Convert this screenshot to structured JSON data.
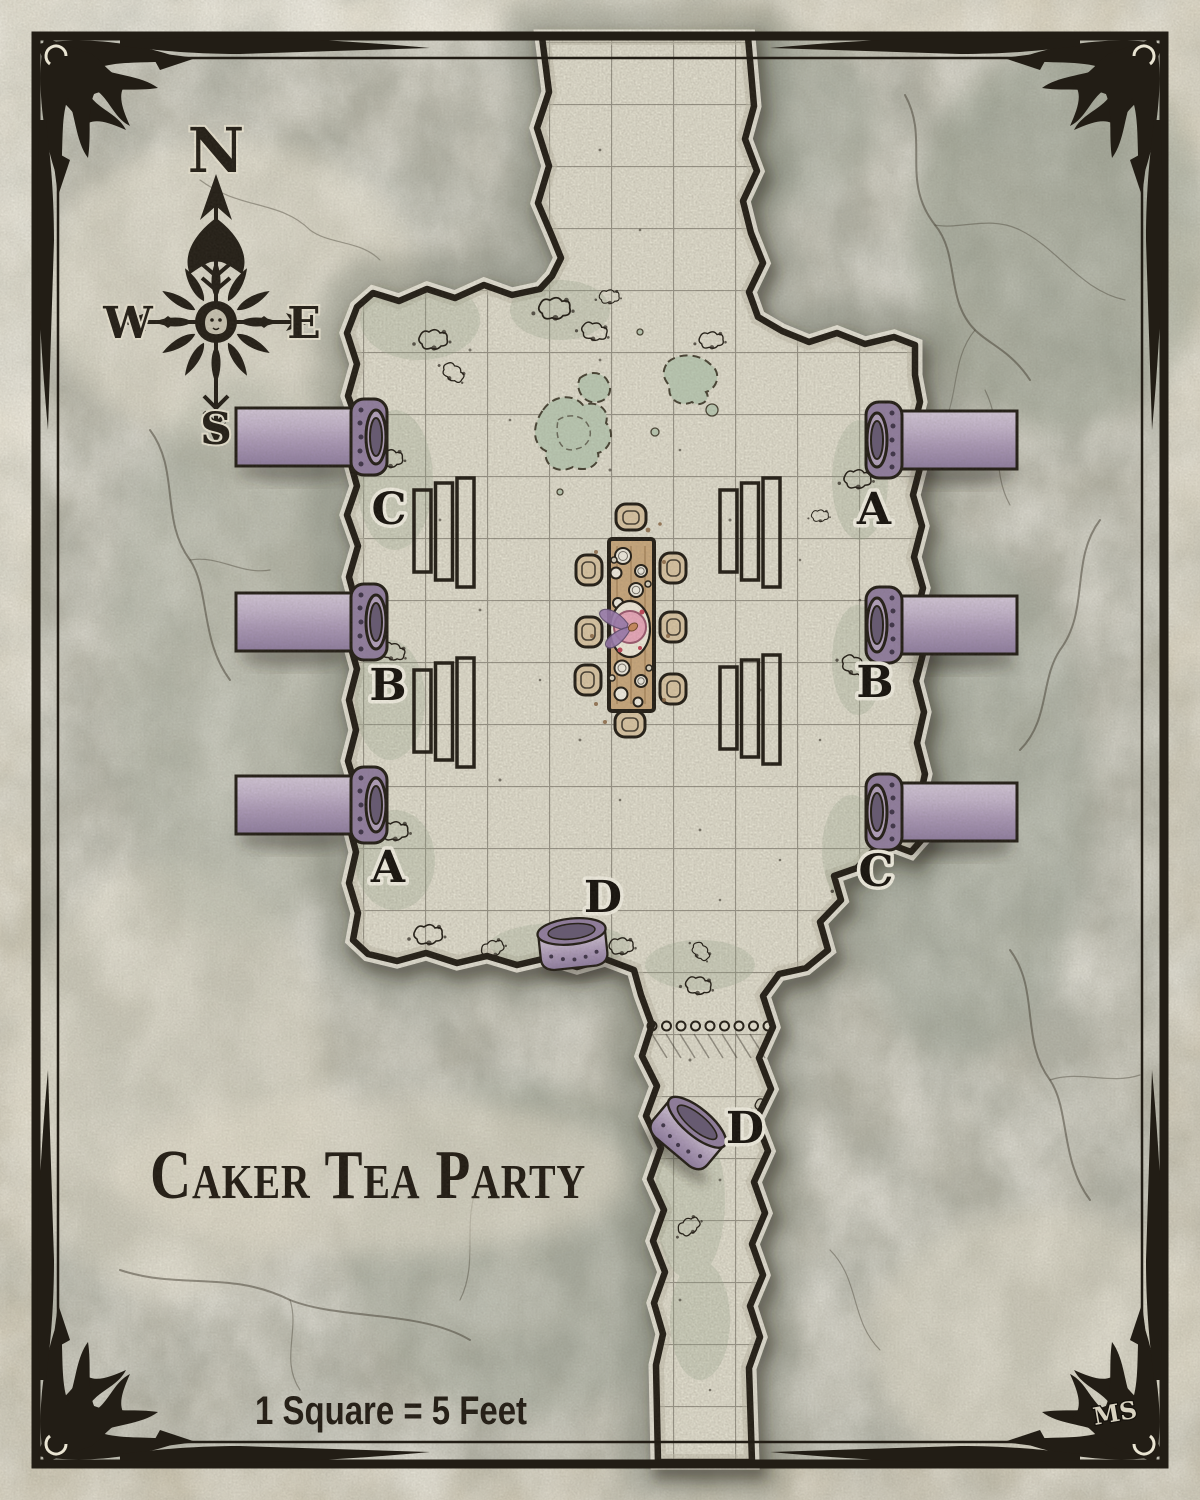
{
  "map": {
    "title": "Caker Tea Party",
    "scale_note": "1 Square = 5 Feet",
    "signature": "MS",
    "compass": {
      "north": "N",
      "east": "E",
      "south": "S",
      "west": "W"
    },
    "pipe_labels": [
      {
        "name": "west-top",
        "text": "C"
      },
      {
        "name": "west-middle",
        "text": "B"
      },
      {
        "name": "west-bottom",
        "text": "A"
      },
      {
        "name": "east-top",
        "text": "A"
      },
      {
        "name": "east-middle",
        "text": "B"
      },
      {
        "name": "east-bottom",
        "text": "C"
      },
      {
        "name": "south-wall",
        "text": "D"
      },
      {
        "name": "corridor",
        "text": "D"
      }
    ]
  },
  "colors": {
    "parchment": "#ddd6c2",
    "stone": "#b5b4a6",
    "floor": "#e8e5d5",
    "grid": "#8e8b7e",
    "ink": "#221d15",
    "halo": "#f2efe2",
    "pipe_mid": "#b2a1bc",
    "pipe_dark": "#927fa0",
    "pipe_hole": "#675a74",
    "wood": "#c9a87d",
    "chair": "#d9c5a3",
    "cake": "#e9a8ba",
    "fairy": "#9b7cb0",
    "puddle": "#bccab4"
  }
}
